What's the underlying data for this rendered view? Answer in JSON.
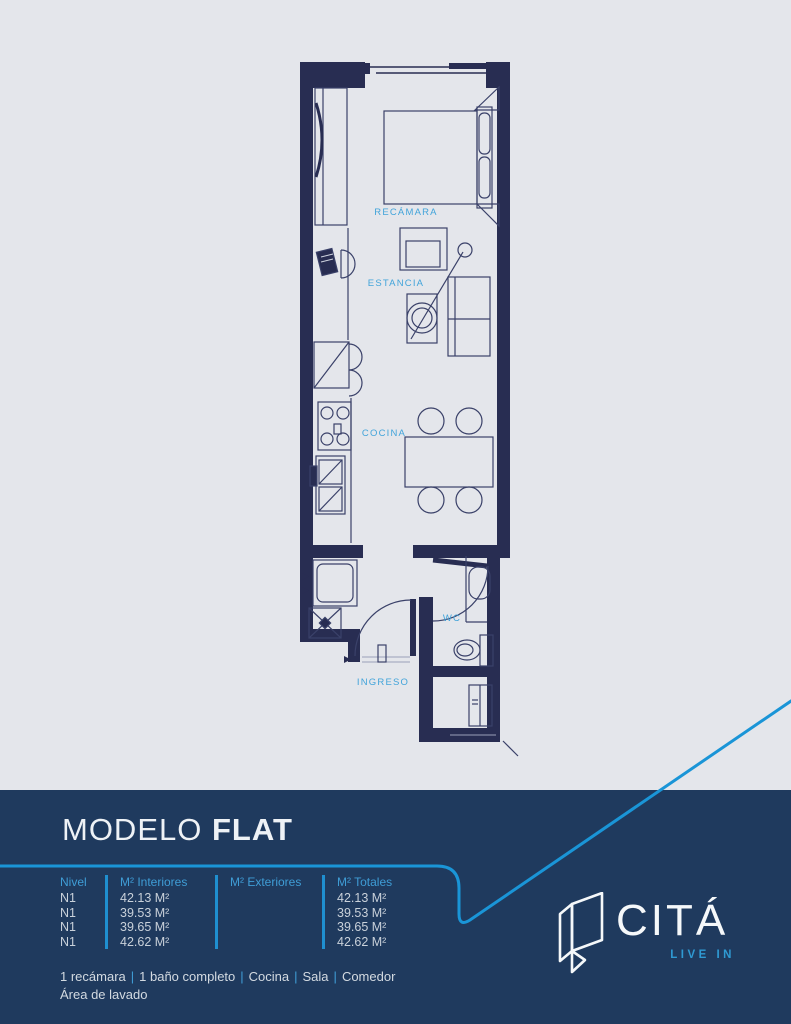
{
  "colors": {
    "background_gray": "#e4e6eb",
    "wall_navy": "#282d52",
    "panel_navy": "#1f3a5e",
    "accent_blue": "#42a4da",
    "swoosh_blue": "#1a95d7",
    "text_light": "#eef2f6"
  },
  "plan": {
    "rooms": {
      "recamara": "RECÁMARA",
      "estancia": "ESTANCIA",
      "cocina": "COCINA",
      "wc": "WC",
      "ingreso": "INGRESO"
    }
  },
  "panel": {
    "title": {
      "light": "MODELO",
      "bold": "FLAT"
    },
    "table": {
      "headers": [
        "Nivel",
        "M² Interiores",
        "M² Exteriores",
        "M² Totales"
      ],
      "rows": [
        {
          "nivel": "N1",
          "interiores": "42.13 M²",
          "exteriores": "",
          "totales": "42.13 M²"
        },
        {
          "nivel": "N1",
          "interiores": "39.53 M²",
          "exteriores": "",
          "totales": "39.53 M²"
        },
        {
          "nivel": "N1",
          "interiores": "39.65 M²",
          "exteriores": "",
          "totales": "39.65 M²"
        },
        {
          "nivel": "N1",
          "interiores": "42.62 M²",
          "exteriores": "",
          "totales": "42.62 M²"
        }
      ]
    },
    "features": {
      "separator": "|",
      "items": [
        "1 recámara",
        "1 baño completo",
        "Cocina",
        "Sala",
        "Comedor"
      ],
      "line2": "Área de lavado"
    },
    "brand": {
      "name": "CITÁ",
      "tagline": "LIVE IN"
    }
  }
}
